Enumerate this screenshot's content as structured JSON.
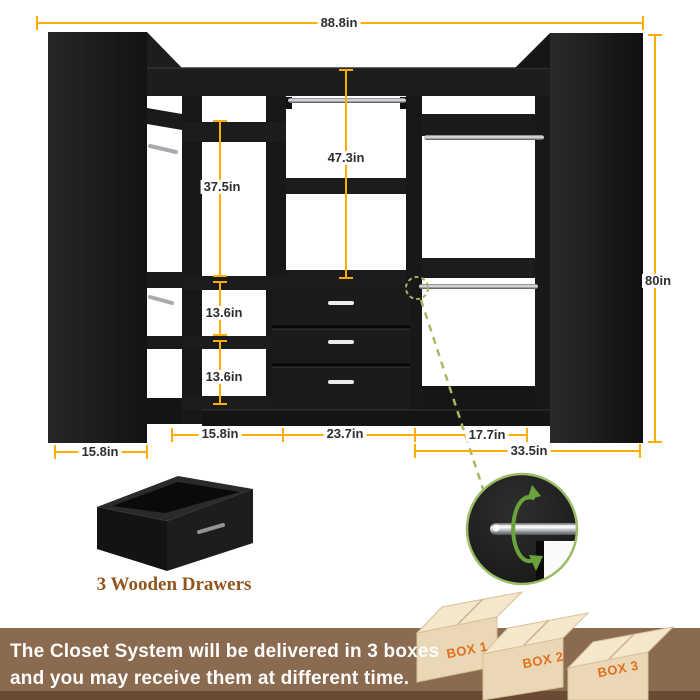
{
  "product": {
    "dimensions": {
      "overall_width": "88.8in",
      "overall_height": "80in",
      "center_tower_height": "47.3in",
      "left_tower_height": "37.5in",
      "upper_cubby_height": "13.6in",
      "lower_cubby_height": "13.6in",
      "left_unit_depth": "15.8in",
      "left_tower_width": "15.8in",
      "center_tower_width": "23.7in",
      "right_tower_width": "17.7in",
      "right_unit_width": "33.5in"
    },
    "drawer_caption": "3 Wooden Drawers"
  },
  "banner": {
    "line1": "The Closet System will be delivered in 3 boxes",
    "line2": "and you may receive them at different time.",
    "boxes": [
      {
        "label": "BOX 1"
      },
      {
        "label": "BOX 2"
      },
      {
        "label": "BOX 3"
      }
    ]
  },
  "colors": {
    "dimension_accent": "#FFAD05",
    "callout_green": "#9BBD68",
    "rotation_arrow_green": "#6AA23C",
    "banner_brown": "#8B6B4F",
    "banner_brown_dark": "#6B4A33",
    "box_cardboard": "#EAD7B5",
    "box_label_orange": "#E0701F",
    "caption_brown": "#92551E",
    "closet_black": "#1A1A1A"
  }
}
